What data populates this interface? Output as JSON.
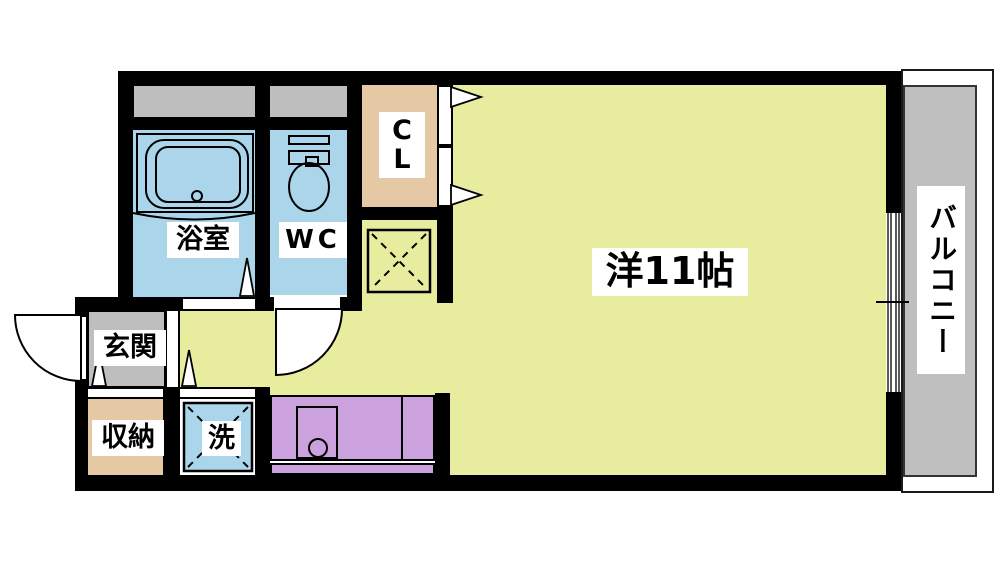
{
  "floorplan": {
    "rooms": {
      "bathroom": {
        "label": "浴室"
      },
      "toilet": {
        "label": "WC"
      },
      "closet": {
        "lines": [
          "C",
          "L"
        ]
      },
      "western_room": {
        "label": "洋11帖"
      },
      "balcony": {
        "label": "バルコニー"
      },
      "entrance": {
        "label": "玄関"
      },
      "storage": {
        "label": "収納"
      },
      "laundry": {
        "label": "洗"
      }
    },
    "colors": {
      "room_floor": "#e7ec9e",
      "wet_area": "#aad5eb",
      "closet_floor": "#e5c8a4",
      "kitchen_counter": "#cba2dd",
      "entrance_floor": "#bebebe",
      "balcony_floor": "#bfbfbf",
      "wall": "#000000",
      "background": "#ffffff"
    }
  }
}
